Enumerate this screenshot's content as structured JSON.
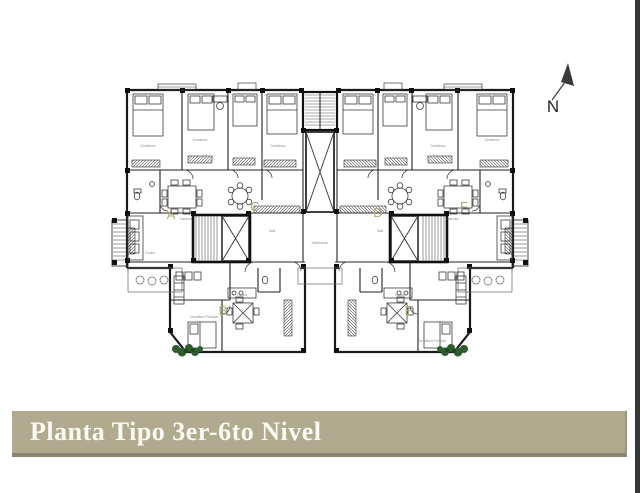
{
  "page": {
    "background_color": "#ffffff",
    "edge_color": "#383838"
  },
  "title_bar": {
    "text": "Planta Tipo 3er-6to Nivel",
    "bg_color": "#b1aa8e",
    "text_color": "#fbfaf2",
    "shadow_color": "#8a8472"
  },
  "north_indicator": {
    "label": "N"
  },
  "plan": {
    "drawing_title_context": "apartment typical floor plan, units A-F",
    "wall_color": "#1a1a1a",
    "unit_label_color": "#b3aa79",
    "plant_color": "#2f5c2c",
    "units": [
      {
        "label": "A"
      },
      {
        "label": "B"
      },
      {
        "label": "C"
      },
      {
        "label": "D"
      },
      {
        "label": "E"
      },
      {
        "label": "F"
      }
    ],
    "room_labels": [
      "Dormitorio",
      "Dormitorio",
      "Dormitorio",
      "Comedor",
      "Cocina",
      "Sala",
      "Dormitorio",
      "Dormitorio",
      "Comedor",
      "Cocina",
      "Sala",
      "Dormitorio Principal",
      "Dormitorio Principal",
      "Distribución",
      "Cocina"
    ]
  }
}
